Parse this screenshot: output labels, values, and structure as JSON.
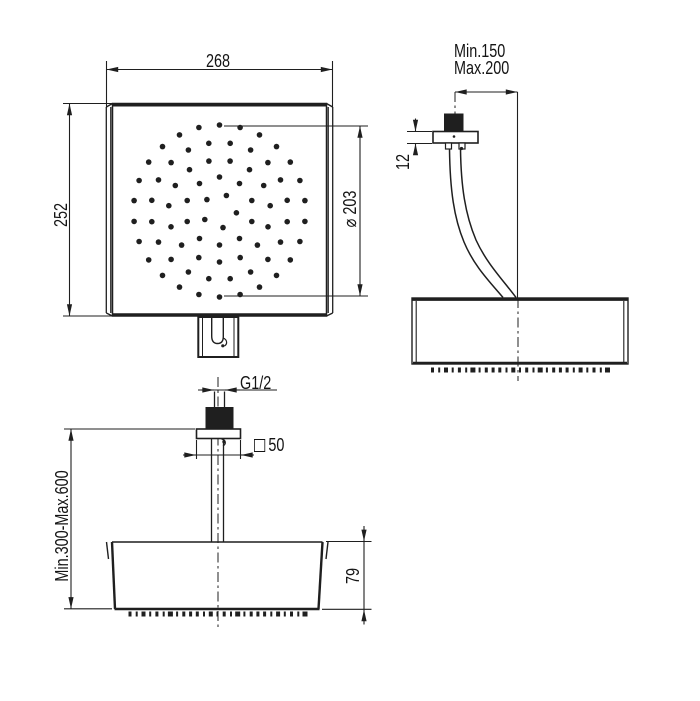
{
  "front_view": {
    "width_dim": "268",
    "height_dim": "252",
    "spray_diameter_dim": "⌀ 203"
  },
  "side_view": {
    "arm_reach_min": "Min.150",
    "arm_reach_max": "Max.200",
    "flange_thickness_dim": "12"
  },
  "ceiling_view": {
    "thread_size": "G1/2",
    "mount_square_symbol": "□",
    "mount_square_dim": "50",
    "drop_tube_range_dim": "Min.300-Max.600",
    "head_thickness_dim": "79"
  },
  "colors": {
    "line": "#1f1f1f",
    "text": "#141414",
    "background": "#ffffff"
  },
  "spray_pattern": {
    "cx": 219.5,
    "cy": 211,
    "dot_radius": 2.8,
    "rings": [
      {
        "radius": 17,
        "count": 5,
        "offset": -66
      },
      {
        "radius": 34,
        "count": 10,
        "offset": -90
      },
      {
        "radius": 51,
        "count": 15,
        "offset": -78
      },
      {
        "radius": 68.5,
        "count": 20,
        "offset": -99
      },
      {
        "radius": 86,
        "count": 26,
        "offset": -90
      }
    ]
  },
  "nozzle_ticks": {
    "count": 27,
    "span": 175,
    "height": 5,
    "widths": [
      3,
      2,
      4,
      2,
      3,
      2,
      5,
      2,
      3,
      3
    ],
    "rows": [
      {
        "cx": 520,
        "y": 367.5
      },
      {
        "cx": 217.5,
        "y": 611.5
      }
    ]
  }
}
